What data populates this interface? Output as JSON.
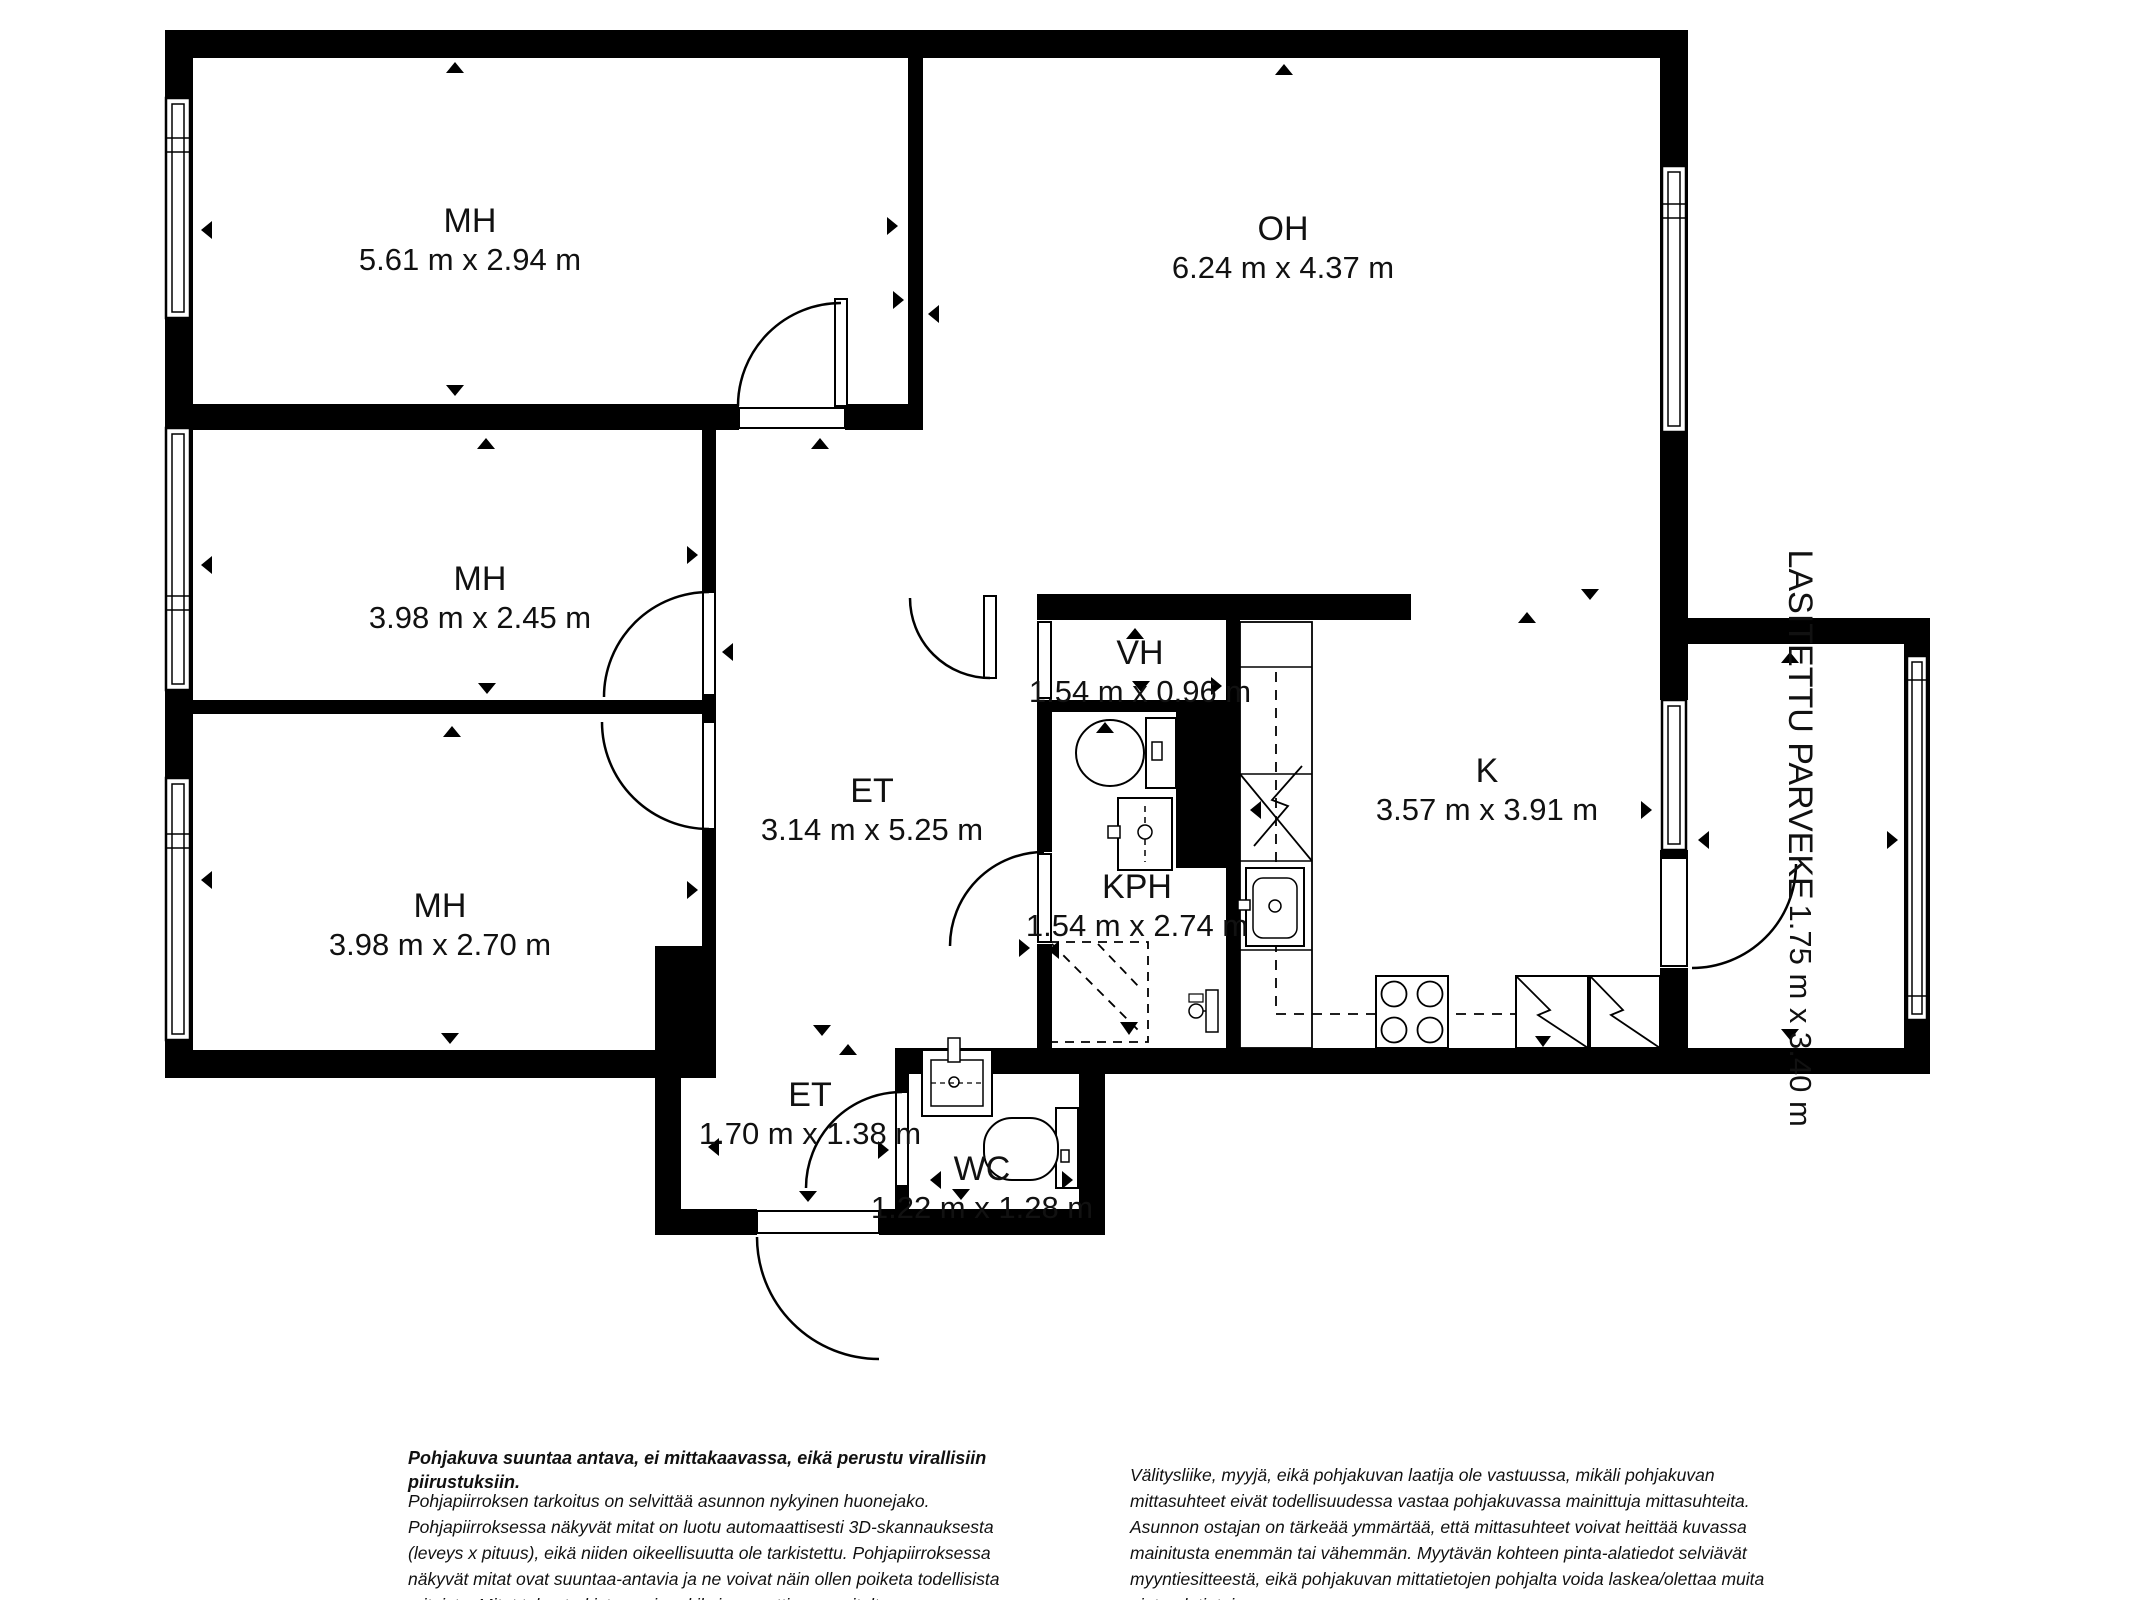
{
  "plan": {
    "title": "Apartment floor plan",
    "colors": {
      "wall": "#000000",
      "background": "#ffffff",
      "text": "#111111"
    },
    "rooms": [
      {
        "id": "mh1",
        "name": "MH",
        "dims": "5.61 m x 2.94 m"
      },
      {
        "id": "oh",
        "name": "OH",
        "dims": "6.24 m x 4.37 m"
      },
      {
        "id": "mh2",
        "name": "MH",
        "dims": "3.98 m x 2.45 m"
      },
      {
        "id": "mh3",
        "name": "MH",
        "dims": "3.98 m x 2.70 m"
      },
      {
        "id": "et",
        "name": "ET",
        "dims": "3.14 m x 5.25 m"
      },
      {
        "id": "vh",
        "name": "VH",
        "dims": "1.54 m x 0.96 m"
      },
      {
        "id": "kph",
        "name": "KPH",
        "dims": "1.54 m x 2.74 m"
      },
      {
        "id": "k",
        "name": "K",
        "dims": "3.57 m x 3.91 m"
      },
      {
        "id": "parveke",
        "name": "LASITETTU PARVEKE",
        "dims": "1.75 m x 3.40 m"
      },
      {
        "id": "et2",
        "name": "ET",
        "dims": "1.70 m x 1.38 m"
      },
      {
        "id": "wc",
        "name": "WC",
        "dims": "1.22 m x 1.28 m"
      }
    ],
    "fixtures": [
      {
        "room": "KPH",
        "items": [
          "toilet",
          "sink",
          "shower",
          "washing-machine-valve"
        ]
      },
      {
        "room": "WC",
        "items": [
          "toilet",
          "sink"
        ]
      },
      {
        "room": "K",
        "items": [
          "kitchen-sink",
          "stove",
          "refrigerator",
          "freezer",
          "counter"
        ]
      }
    ]
  },
  "disclaimer": {
    "title": "Pohjakuva suuntaa antava, ei mittakaavassa, eikä perustu virallisiin piirustuksiin.",
    "left_paragraph": "Pohjapiirroksen tarkoitus on selvittää asunnon nykyinen huonejako. Pohjapiirroksessa näkyvät mitat on luotu automaattisesti 3D-skannauksesta (leveys x pituus), eikä niiden oikeellisuutta ole tarkistettu. Pohjapiirroksessa näkyvät mitat ovat suuntaa-antavia ja ne voivat näin ollen poiketa todellisista mitoista. Mitat tulee tarkistaa esimerkiksi remonttia suunniteltaessa. Mittauskohdat on merkitty kuvaan pienillä kolmioilla.",
    "right_paragraph": "Välitysliike, myyjä, eikä pohjakuvan laatija ole vastuussa, mikäli pohjakuvan mittasuhteet eivät todellisuudessa vastaa pohjakuvassa mainittuja mittasuhteita. Asunnon ostajan on tärkeää ymmärtää, että mittasuhteet voivat heittää kuvassa mainitusta enemmän tai vähemmän. Myytävän kohteen pinta-alatiedot selviävät myyntiesitteestä, eikä pohjakuvan mittatietojen pohjalta voida laskea/olettaa muita pinta-alatietoja."
  }
}
